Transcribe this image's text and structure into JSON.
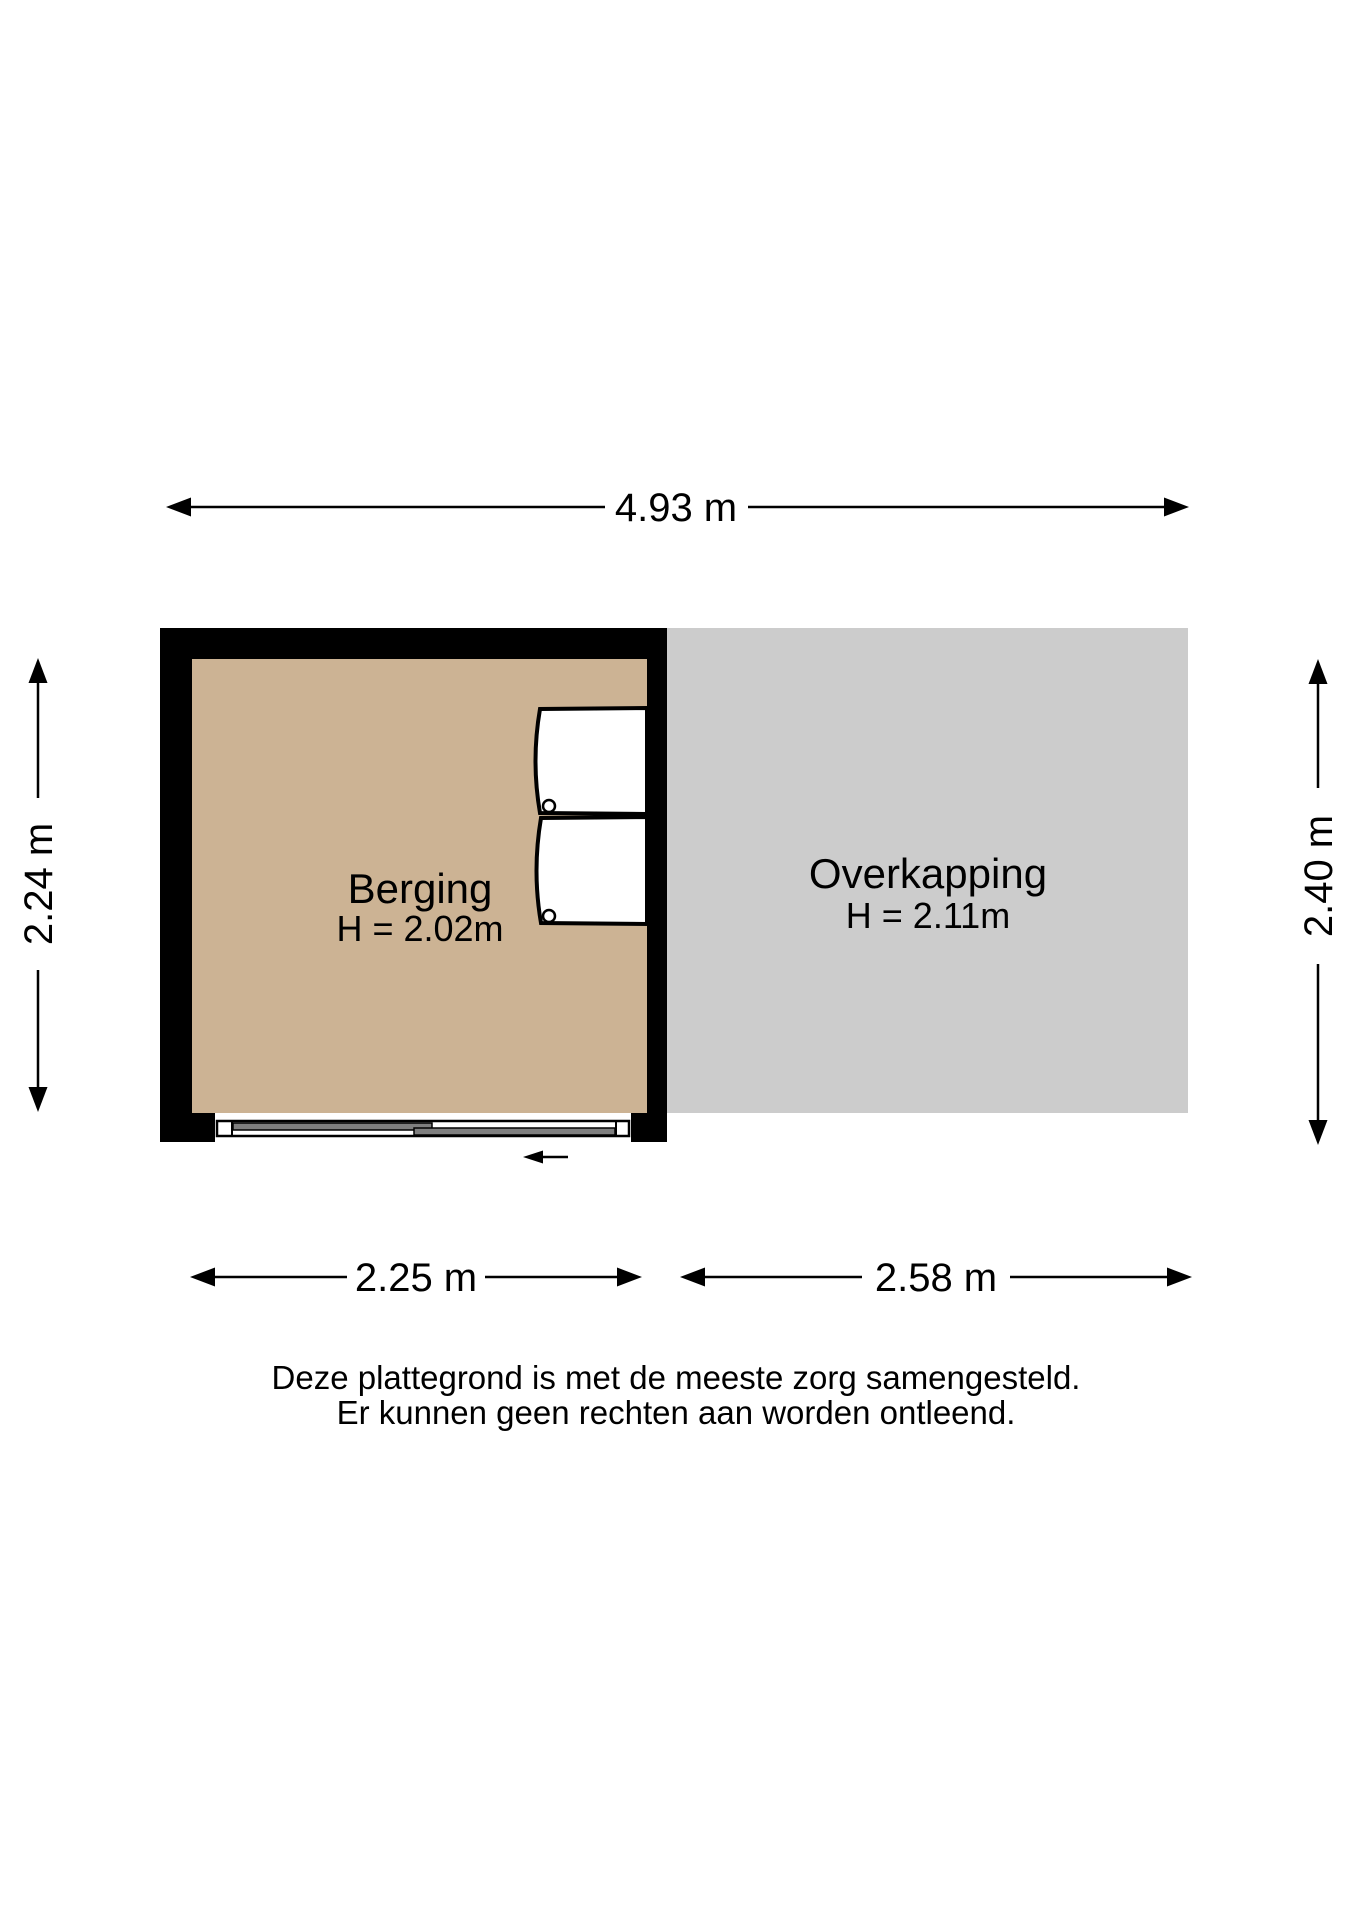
{
  "colors": {
    "wall": "#000000",
    "berging_floor": "#ccb394",
    "overkapping_floor": "#cccccc",
    "door_panel": "#7f7f7f",
    "background": "#ffffff"
  },
  "rooms": {
    "berging": {
      "label": "Berging",
      "height": "H = 2.02m"
    },
    "overkapping": {
      "label": "Overkapping",
      "height": "H = 2.11m"
    }
  },
  "dimensions": {
    "top": "4.93 m",
    "left": "2.24 m",
    "right": "2.40 m",
    "bottom_left": "2.25 m",
    "bottom_right": "2.58 m"
  },
  "disclaimer": {
    "line1": "Deze plattegrond is met de meeste zorg samengesteld.",
    "line2": "Er kunnen geen rechten aan worden ontleend."
  }
}
